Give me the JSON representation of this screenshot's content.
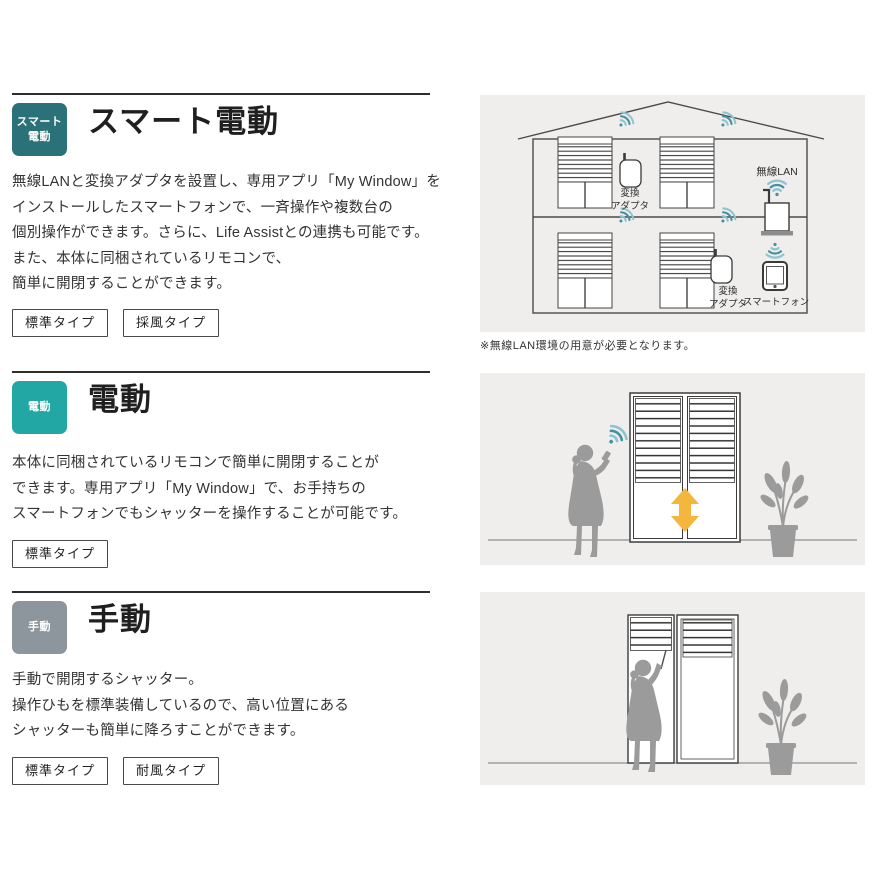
{
  "sections": [
    {
      "badge_lines": [
        "スマート",
        "電動"
      ],
      "badge_color": "#2b7278",
      "title": "スマート電動",
      "body": [
        "無線LANと変換アダプタを設置し、専用アプリ「My Window」を",
        "インストールしたスマートフォンで、一斉操作や複数台の",
        "個別操作ができます。さらに、Life Assistとの連携も可能です。",
        "また、本体に同梱されているリモコンで、",
        "簡単に開閉することができます。"
      ],
      "buttons": [
        "標準タイプ",
        "採風タイプ"
      ]
    },
    {
      "badge_lines": [
        "電動"
      ],
      "badge_color": "#22a7a4",
      "title": "電動",
      "body": [
        "本体に同梱されているリモコンで簡単に開閉することが",
        "できます。専用アプリ「My Window」で、お手持ちの",
        "スマートフォンでもシャッターを操作することが可能です。"
      ],
      "buttons": [
        "標準タイプ"
      ]
    },
    {
      "badge_lines": [
        "手動"
      ],
      "badge_color": "#8e969d",
      "title": "手動",
      "body": [
        "手動で開閉するシャッター。",
        "操作ひもを標準装備しているので、高い位置にある",
        "シャッターも簡単に降ろすことができます。"
      ],
      "buttons": [
        "標準タイプ",
        "耐風タイプ"
      ]
    }
  ],
  "house": {
    "wireless_lan_label": "無線LAN",
    "adapter_label_line1": "変換",
    "adapter_label_line2": "アダプタ",
    "smartphone_label": "スマートフォン",
    "note": "※無線LAN環境の用意が必要となります。"
  },
  "colors": {
    "wifi_dark": "#46919f",
    "wifi_light": "#8fc3cf",
    "arrow_orange": "#f4b63c",
    "silhouette_gray": "#9b9b9b",
    "panel_bg": "#efeeec"
  }
}
